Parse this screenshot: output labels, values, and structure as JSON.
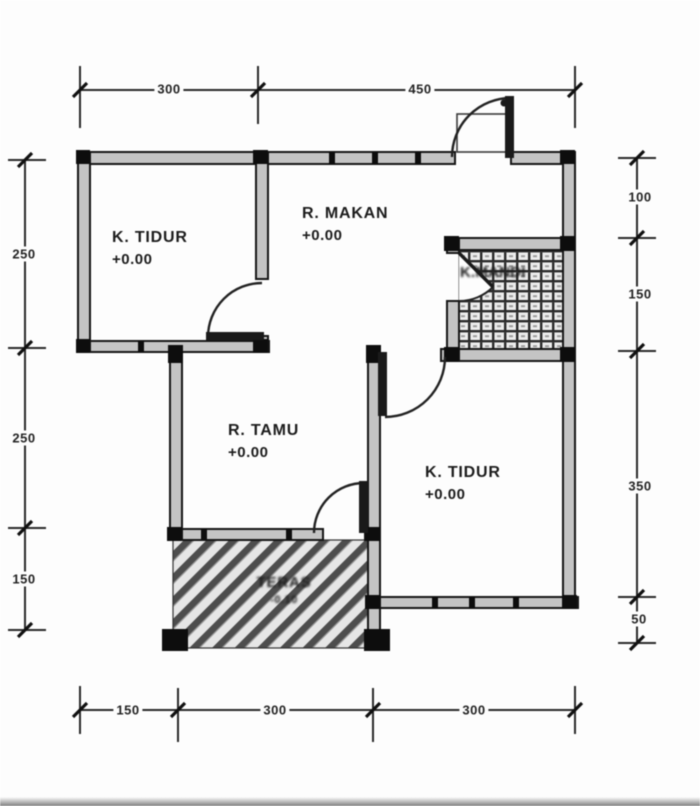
{
  "rooms": [
    {
      "id": "bedroom-1",
      "name": "K. TIDUR",
      "level": "+0.00"
    },
    {
      "id": "dining-room",
      "name": "R. MAKAN",
      "level": "+0.00"
    },
    {
      "id": "bathroom",
      "name": "K.MANDI",
      "level": ""
    },
    {
      "id": "living-room",
      "name": "R. TAMU",
      "level": "+0.00"
    },
    {
      "id": "bedroom-2",
      "name": "K. TIDUR",
      "level": "+0.00"
    },
    {
      "id": "terrace",
      "name": "TERAS",
      "level": "-0.10"
    }
  ],
  "dimensions_cm": {
    "top": [
      "300",
      "450"
    ],
    "left": [
      "250",
      "250",
      "150"
    ],
    "right": [
      "100",
      "150",
      "350",
      "50"
    ],
    "bottom": [
      "150",
      "300",
      "300"
    ]
  },
  "colors": {
    "line": "#1a1a1a",
    "wall_fill": "#c4c4c4",
    "paper": "#fdfdfd"
  }
}
